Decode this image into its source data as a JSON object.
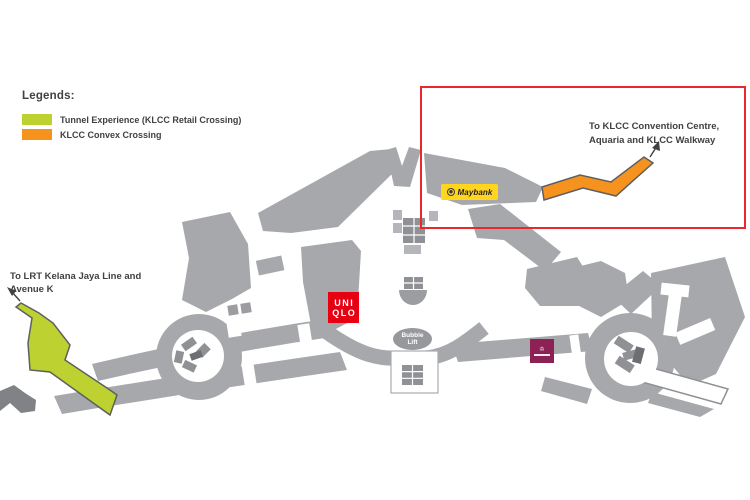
{
  "legend": {
    "title": "Legends:",
    "items": [
      {
        "label": "Tunnel Experience (KLCC Retail Crossing)",
        "color": "#bdd231"
      },
      {
        "label": "KLCC Convex Crossing",
        "color": "#f6921e"
      }
    ]
  },
  "labels": {
    "lrt_line1": "To LRT Kelana Jaya Line and",
    "lrt_line2": "Avenue K",
    "convention_line1": "To KLCC Convention Centre,",
    "convention_line2": "Aquaria and KLCC Walkway"
  },
  "badges": {
    "maybank": {
      "label": "Maybank",
      "bg": "#ffd51f",
      "text_color": "#231f20"
    },
    "uniqlo": {
      "line1": "UNI",
      "line2": "QLO",
      "bg": "#e60012"
    },
    "bubble_lift": {
      "line1": "Bubble",
      "line2": "Lift",
      "bg": "#96989b"
    },
    "purple_store": {
      "bg": "#8b2155",
      "icon": "crown-icon"
    }
  },
  "colors": {
    "floor_gray": "#a6a8ab",
    "dark_gray": "#808285",
    "tunnel_green": "#bdd231",
    "convex_orange": "#f6921e",
    "highlight_red": "#e9282e",
    "outline": "#5e5f61",
    "text": "#414042"
  },
  "icons": {
    "maybank_tiger": "tiger-head-icon",
    "crown": "♔",
    "escalator": "grid-block",
    "direction_arrow": "thin-line-arrow"
  }
}
